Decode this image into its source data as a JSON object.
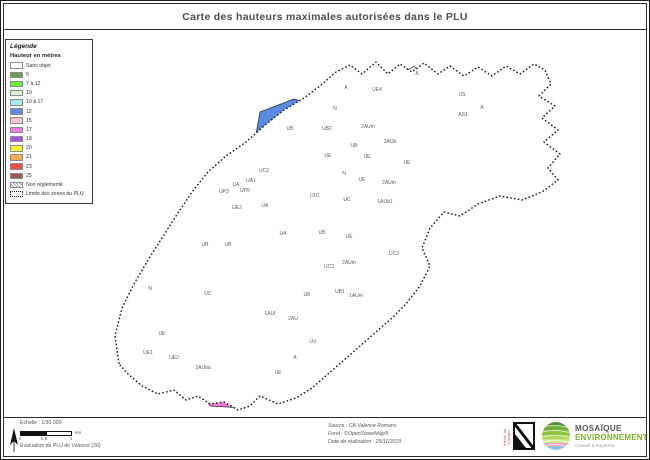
{
  "title": "Carte des hauteurs maximales autorisées dans le PLU",
  "colors": {
    "h5": "#6b9e52",
    "h7_12": "#66f23a",
    "h10": "#d9f2c8",
    "h10_17": "#a6e9f7",
    "h12": "#5a8ae3",
    "h15": "#f7c3c9",
    "h17": "#f07cd9",
    "h18": "#a852db",
    "h20": "#f8f238",
    "h21": "#f4ae4f",
    "h23": "#f04b45",
    "h25": "#9c5a50",
    "dark": "#3a3a3a"
  },
  "legend": {
    "title": "Légende",
    "subtitle": "Hauteur en mètres",
    "items": [
      {
        "label": "Sans objet",
        "color_key": "none"
      },
      {
        "label": "5",
        "color_key": "h5"
      },
      {
        "label": "7 à 12",
        "color_key": "h7_12"
      },
      {
        "label": "10",
        "color_key": "h10"
      },
      {
        "label": "10 à 17",
        "color_key": "h10_17"
      },
      {
        "label": "12",
        "color_key": "h12"
      },
      {
        "label": "15",
        "color_key": "h15"
      },
      {
        "label": "17",
        "color_key": "h17"
      },
      {
        "label": "18",
        "color_key": "h18"
      },
      {
        "label": "20",
        "color_key": "h20"
      },
      {
        "label": "21",
        "color_key": "h21"
      },
      {
        "label": "23",
        "color_key": "h23"
      },
      {
        "label": "25",
        "color_key": "h25"
      }
    ],
    "special_items": [
      {
        "label": "Non réglementé",
        "style": "hatched"
      },
      {
        "label": "Limite des zones du PLU",
        "style": "dashed"
      }
    ]
  },
  "map": {
    "labels": [
      {
        "t": "A",
        "x": 344,
        "y": 87
      },
      {
        "t": "UE4",
        "x": 375,
        "y": 89
      },
      {
        "t": "A",
        "x": 415,
        "y": 73
      },
      {
        "t": "N",
        "x": 333,
        "y": 108
      },
      {
        "t": "UB",
        "x": 288,
        "y": 128
      },
      {
        "t": "UB2",
        "x": 325,
        "y": 128
      },
      {
        "t": "2AUm",
        "x": 366,
        "y": 126
      },
      {
        "t": "2AUb",
        "x": 388,
        "y": 141
      },
      {
        "t": "UB",
        "x": 352,
        "y": 145
      },
      {
        "t": "UE",
        "x": 326,
        "y": 155
      },
      {
        "t": "UE",
        "x": 365,
        "y": 156
      },
      {
        "t": "N",
        "x": 342,
        "y": 173
      },
      {
        "t": "UE",
        "x": 360,
        "y": 179
      },
      {
        "t": "2AUm",
        "x": 387,
        "y": 182
      },
      {
        "t": "UE",
        "x": 405,
        "y": 162
      },
      {
        "t": "UC2",
        "x": 262,
        "y": 170
      },
      {
        "t": "UA",
        "x": 234,
        "y": 184
      },
      {
        "t": "UA1",
        "x": 249,
        "y": 180
      },
      {
        "t": "UP3",
        "x": 222,
        "y": 191
      },
      {
        "t": "UP5",
        "x": 243,
        "y": 190
      },
      {
        "t": "UE2",
        "x": 235,
        "y": 207
      },
      {
        "t": "UA",
        "x": 263,
        "y": 205
      },
      {
        "t": "UD1",
        "x": 313,
        "y": 195
      },
      {
        "t": "UC",
        "x": 345,
        "y": 199
      },
      {
        "t": "1AUb1",
        "x": 383,
        "y": 201
      },
      {
        "t": "UA",
        "x": 281,
        "y": 233
      },
      {
        "t": "UB",
        "x": 320,
        "y": 232
      },
      {
        "t": "UE",
        "x": 347,
        "y": 236
      },
      {
        "t": "UC3",
        "x": 392,
        "y": 253
      },
      {
        "t": "UC2",
        "x": 327,
        "y": 266
      },
      {
        "t": "2AUm",
        "x": 347,
        "y": 262
      },
      {
        "t": "UB1",
        "x": 338,
        "y": 291
      },
      {
        "t": "UB",
        "x": 305,
        "y": 294
      },
      {
        "t": "1AUm",
        "x": 354,
        "y": 295
      },
      {
        "t": "N",
        "x": 148,
        "y": 288
      },
      {
        "t": "UC",
        "x": 206,
        "y": 293
      },
      {
        "t": "UB",
        "x": 203,
        "y": 244
      },
      {
        "t": "UB",
        "x": 226,
        "y": 244
      },
      {
        "t": "1AUI",
        "x": 268,
        "y": 313
      },
      {
        "t": "2AU",
        "x": 291,
        "y": 318
      },
      {
        "t": "UV",
        "x": 311,
        "y": 341
      },
      {
        "t": "A",
        "x": 293,
        "y": 357
      },
      {
        "t": "UE",
        "x": 160,
        "y": 333
      },
      {
        "t": "UE1",
        "x": 146,
        "y": 352
      },
      {
        "t": "UE2",
        "x": 172,
        "y": 357
      },
      {
        "t": "2AUba",
        "x": 201,
        "y": 367
      },
      {
        "t": "UE",
        "x": 276,
        "y": 372
      },
      {
        "t": "US",
        "x": 460,
        "y": 94
      },
      {
        "t": "AS1",
        "x": 461,
        "y": 114
      },
      {
        "t": "A",
        "x": 480,
        "y": 107
      }
    ]
  },
  "footer": {
    "scale_text": "Echelle : 1/35 000",
    "scale_unit": "km",
    "scale_ticks": [
      "0",
      "0,5",
      "1"
    ],
    "eval_text": "Evaluation du PLU de Valence (26)",
    "source_lines": [
      "Source : CA Valence Romans",
      "Fond : ©OpenStreetMap®",
      "Date de réalisation : 29/11/2019"
    ],
    "logos": {
      "atelier": "Atelier du triangle",
      "mosaique_name": "MOSAÏQUE",
      "mosaique_sub": "ENVIRONNEMENT",
      "mosaique_tagline": "Conseil & Expertise"
    }
  }
}
